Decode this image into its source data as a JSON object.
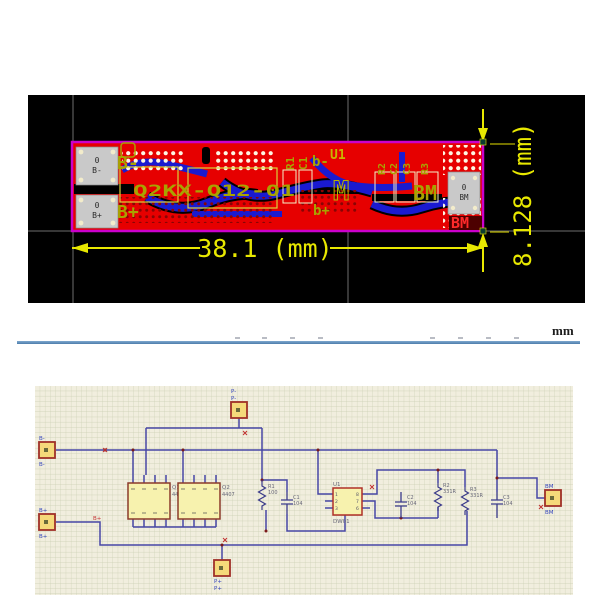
{
  "pcb": {
    "dim_width": "38.1 (mm)",
    "dim_height": "8.128 (mm)",
    "pad_left_top": {
      "l1": "0",
      "l2": "B-"
    },
    "pad_left_bottom": {
      "l1": "0",
      "l2": "B+"
    },
    "pad_right": {
      "l1": "0",
      "l2": "BM"
    },
    "silk": {
      "b_minus": "B-",
      "b_plus": "B+",
      "model_line": "Q2KX-Q12-01",
      "r1": "R1",
      "c1": "C1",
      "u1": "U1",
      "m_mark": "M",
      "b_minus_small": "b-",
      "b_plus_small": "b+",
      "r2": "R2",
      "c2": "C2",
      "c3": "C3",
      "r3": "R3",
      "bm_olive": "BM",
      "bm_red": "BM"
    }
  },
  "ruler": {
    "unit": "mm"
  },
  "schematic": {
    "conn_b_minus": {
      "top": "B-",
      "bottom": "B-"
    },
    "conn_b_plus": {
      "top": "B+",
      "bottom": "B+",
      "net": "B+"
    },
    "conn_p_minus": {
      "l1": "P-",
      "l2": "P-"
    },
    "conn_p_plus": {
      "l1": "P+",
      "l2": "P+"
    },
    "conn_bm": {
      "top": "BM",
      "bottom": "BM"
    },
    "q1": {
      "des": "Q1",
      "part": "4407"
    },
    "q2": {
      "des": "Q2",
      "part": "4407"
    },
    "u1": {
      "des": "U1",
      "part": "DW01",
      "pins_left": [
        "1",
        "2",
        "3"
      ],
      "pins_right": [
        "8",
        "7",
        "6"
      ]
    },
    "r1": {
      "des": "R1",
      "val": "100"
    },
    "r2": {
      "des": "R2",
      "val": "331R"
    },
    "r3": {
      "des": "R3",
      "val": "331R"
    },
    "c1": {
      "des": "C1",
      "val": "104"
    },
    "c2": {
      "des": "C2",
      "val": "104"
    },
    "c3": {
      "des": "C3",
      "val": "104"
    }
  },
  "colors": {
    "board_red": "#e60000",
    "trace_blue": "#1a1ad0",
    "outline_magenta": "#cc00cc",
    "silk_olive": "#a8a300",
    "dim_yellow": "#e8e800",
    "wire_blue": "#4747a5",
    "sch_bg": "#f1eede"
  }
}
